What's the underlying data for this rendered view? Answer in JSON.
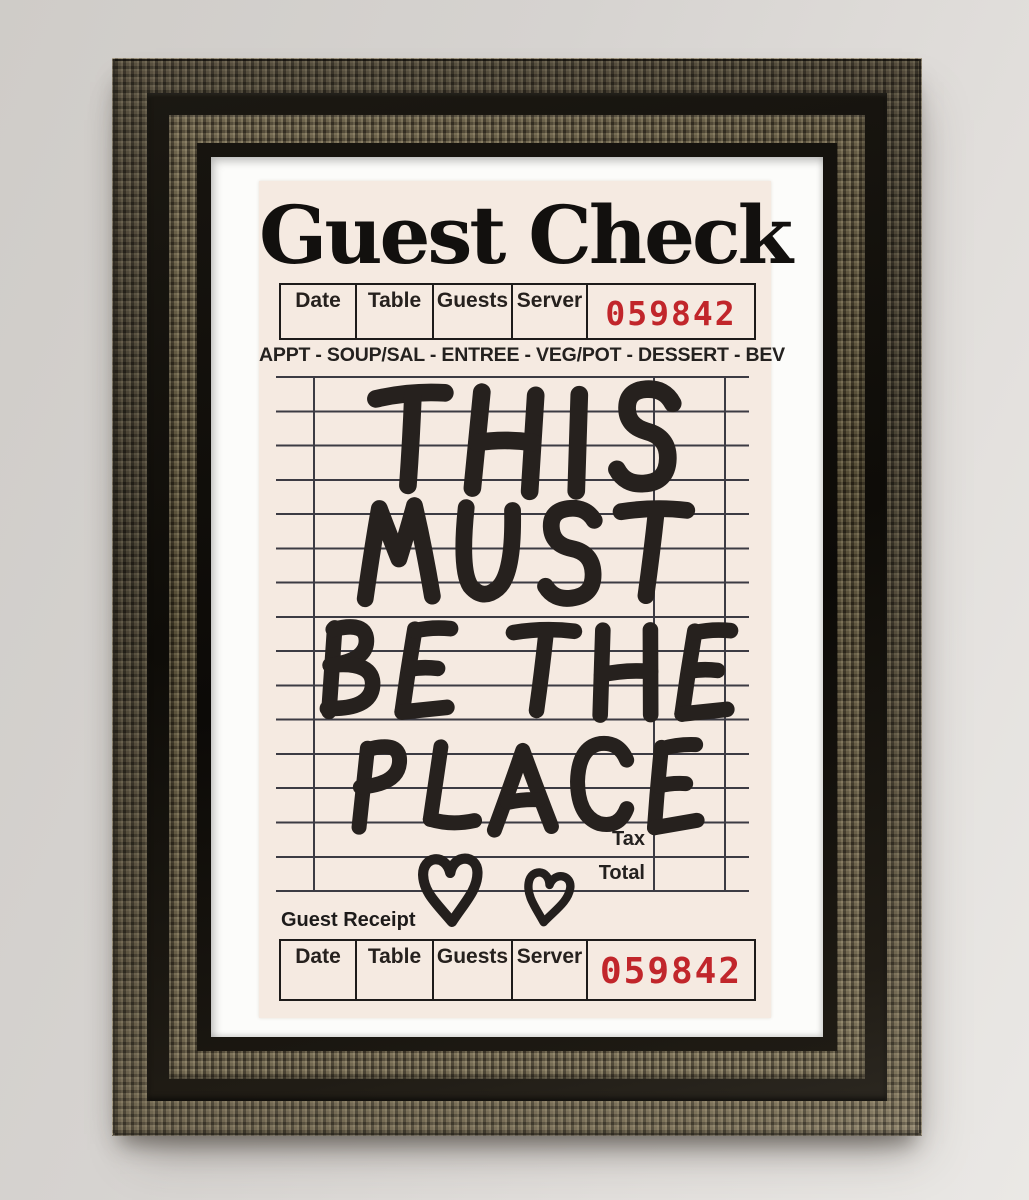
{
  "art": {
    "title": "Guest Check",
    "header_table": {
      "columns": [
        "Date",
        "Table",
        "Guests",
        "Server"
      ],
      "check_number": "059842"
    },
    "route_line": "APPT - SOUP/SAL - ENTREE - VEG/POT - DESSERT - BEV",
    "message_lines": [
      "THIS",
      "MUST",
      "BE THE",
      "PLACE"
    ],
    "totals": {
      "tax_label": "Tax",
      "total_label": "Total"
    },
    "receipt_section": {
      "label": "Guest Receipt",
      "columns": [
        "Date",
        "Table",
        "Guests",
        "Server"
      ],
      "receipt_number": "059842"
    },
    "icons": [
      "heart-doodle-icon",
      "heart-doodle-icon"
    ],
    "colors": {
      "number_red": "#c1262b",
      "paper": "#f5eae1",
      "ink": "#26211e",
      "grid_line": "#3c3b43"
    }
  }
}
